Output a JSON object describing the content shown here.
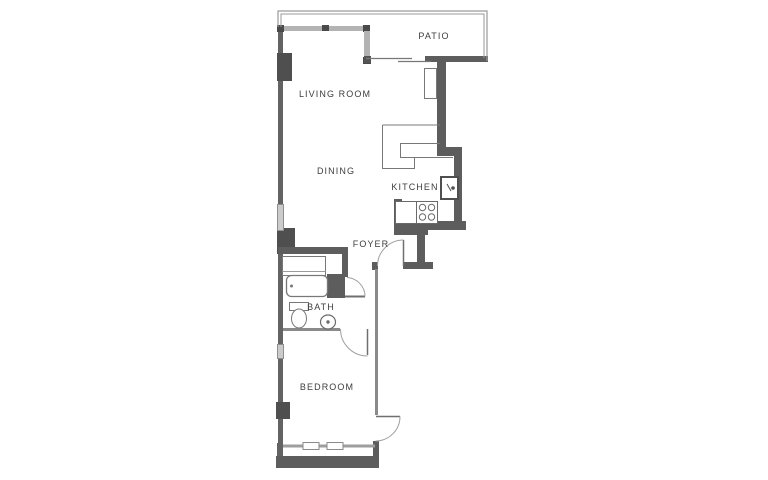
{
  "plan": {
    "type": "apartment-floor-plan",
    "rooms": [
      {
        "id": "patio",
        "label": "PATIO"
      },
      {
        "id": "living-room",
        "label": "LIVING ROOM"
      },
      {
        "id": "dining",
        "label": "DINING"
      },
      {
        "id": "kitchen",
        "label": "KITCHEN"
      },
      {
        "id": "foyer",
        "label": "FOYER"
      },
      {
        "id": "bath",
        "label": "BATH"
      },
      {
        "id": "bedroom",
        "label": "BEDROOM"
      }
    ],
    "fixtures": [
      "kitchen-counter",
      "kitchen-sink",
      "stove-four-burners",
      "base-cabinet",
      "utility-shaft",
      "closet",
      "bathtub",
      "toilet",
      "bath-sink"
    ],
    "doors": [
      "entry-door",
      "bath-door",
      "hall-door",
      "bedroom-door",
      "patio-sliding-door"
    ],
    "windows": [
      "living-room-window-wall",
      "dining-window",
      "bedroom-side-window",
      "bedroom-rear-windows",
      "patio-railing"
    ],
    "colors": {
      "wall": "#5d5d5d",
      "wall_dark": "#4a4a4a",
      "window_wall": "#b3b3b3",
      "thin_line": "#787878",
      "arc_line": "#9f9f9f",
      "railing": "#9a9a9a",
      "text": "#3d3d3d",
      "background": "#ffffff"
    }
  }
}
